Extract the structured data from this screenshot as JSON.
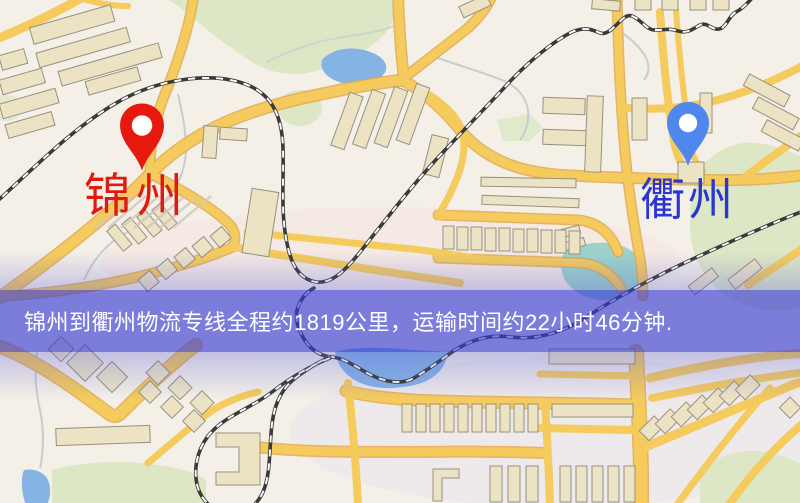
{
  "banner": {
    "text": "锦州到衢州物流专线全程约1819公里，运输时间约22小时46分钟."
  },
  "markers": {
    "origin": {
      "label": "锦州",
      "icon": "red-location-pin-icon"
    },
    "destination": {
      "label": "衢州",
      "icon": "blue-location-pin-icon"
    }
  },
  "colors": {
    "map_bg": "#f4efe7",
    "road": "#f4cb5c",
    "road_casing": "#e2a94d",
    "building": "#ece3c4",
    "building_line": "#97917f",
    "park": "#dde7c5",
    "water": "#85b4e4",
    "pond_teal": "#92cfc6",
    "rail": "#3a3a38",
    "rail_dash": "#ffffff",
    "stream": "#c7ccd2",
    "banner_overlay": "rgba(57,60,213,0.64)",
    "banner_text": "#ffffff",
    "origin_pin": "#e6190e",
    "origin_label": "#df1a10",
    "destination_pin": "#4f87ee",
    "destination_label": "#2b36d0"
  }
}
